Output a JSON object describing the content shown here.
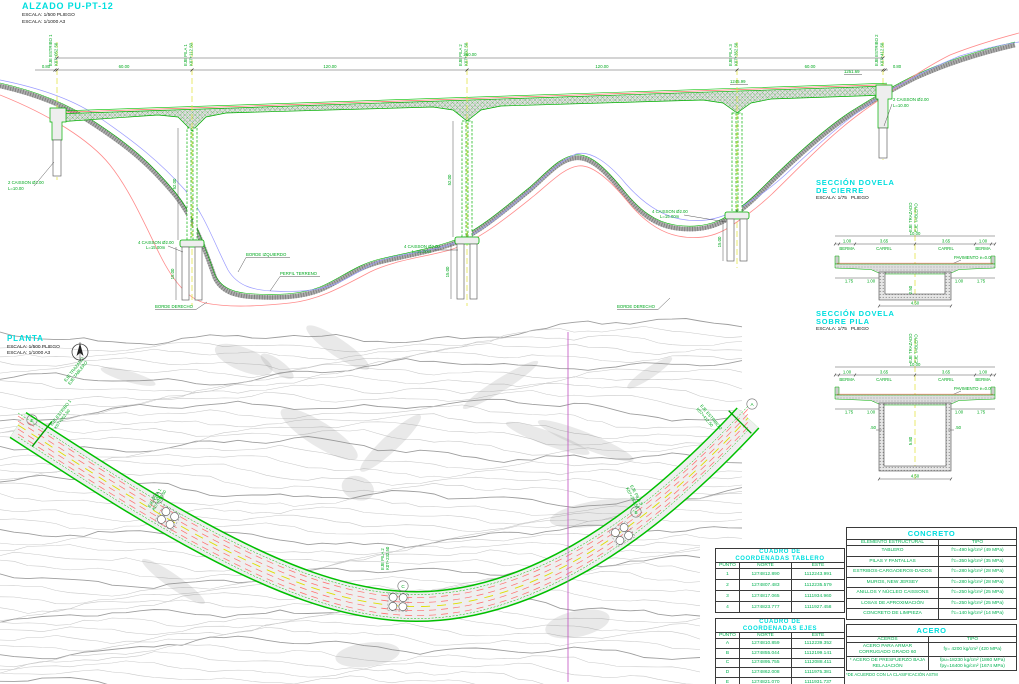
{
  "elevation": {
    "title": "ALZADO PU-PT-12",
    "scale1": "ESCALA: 1/500 PLIEGO",
    "scale2": "ESCALA: 1/1000 A3",
    "total_dim": "360.00",
    "dims": [
      "0.80",
      "60.00",
      "120.00",
      "120.00",
      "60.00",
      "0.80"
    ],
    "axes": [
      {
        "name": "EJE ESTRIBO 1",
        "station": "K07+052.50"
      },
      {
        "name": "EJE PILA 1",
        "station": "K07+112.50"
      },
      {
        "name": "EJE PILA 2",
        "station": "K07+232.50"
      },
      {
        "name": "EJE PILA 3",
        "station": "K07+352.50"
      },
      {
        "name": "EJE ESTRIBO 2",
        "station": "K07+412.50"
      }
    ],
    "caisson_abutment": "2 CAISSON Ø2.00",
    "caisson_abutment_len": "L=10.00",
    "caisson_pier": "4 CAISSON Ø2.00",
    "caisson_pier_len": "L=15.00m",
    "terrain": {
      "borde_izquierdo": "BORDE IZQUIERDO",
      "perfil": "PERFIL TERRENO",
      "borde_derecho": "BORDE DERECHO"
    },
    "pier_height": "52.00",
    "caisson_depth": "15.00",
    "spot_levels": [
      "1245.99",
      "1251.69"
    ]
  },
  "sections": {
    "cierre": {
      "title": "SECCIÓN DOVELA\nDE CIERRE",
      "scale": "ESCALA: 1/75   PLIEGO",
      "depth": "2.50"
    },
    "pila": {
      "title": "SECCIÓN DOVELA\nSOBRE PILA",
      "scale": "ESCALA: 1/75   PLIEGO",
      "depth": "5.80",
      "wall": ".50"
    },
    "labels": {
      "eje_trazado": "EJE TRAZADO",
      "eje_tablero": "EJE TABLERO",
      "total": "10.00",
      "berma": "BERMA",
      "carril": "CARRIL",
      "d_berma": "1.00",
      "d_carril": "3.65",
      "pavimento": "PAVIMENTO e=0.05",
      "d_wing": "1.75",
      "d_inner": "1.00",
      "d_bottom": "4.50"
    }
  },
  "plan": {
    "title": "PLANTA",
    "scale1": "ESCALA: 1/500 PLIEGO",
    "scale2": "ESCALA: 1/1000 A3",
    "eje_trazado": "EJE TRAZADO",
    "eje_tablero": "EJE TABLERO",
    "points": [
      "A",
      "B",
      "C",
      "D",
      "E"
    ]
  },
  "tables": {
    "tablero": {
      "title": "CUADRO DE\nCOORDENADAS TABLERO",
      "headers": [
        "PUNTO",
        "NORTE",
        "ESTE"
      ],
      "rows": [
        [
          "1",
          "1274812.890",
          "1112243.991"
        ],
        [
          "2",
          "1274807.483",
          "1112235.579"
        ],
        [
          "3",
          "1274817.065",
          "1111934.960"
        ],
        [
          "4",
          "1274823.777",
          "1111927.458"
        ]
      ]
    },
    "ejes": {
      "title": "CUADRO DE\nCOORDENADAS EJES",
      "headers": [
        "PUNTO",
        "NORTE",
        "ESTE"
      ],
      "rows": [
        [
          "A",
          "1274810.859",
          "1112239.352"
        ],
        [
          "B",
          "1274855.044",
          "1112199.141"
        ],
        [
          "C",
          "1274895.755",
          "1112088.411"
        ],
        [
          "D",
          "1274862.008",
          "1111975.381"
        ],
        [
          "E",
          "1274821.070",
          "1111931.737"
        ]
      ]
    },
    "concreto": {
      "title": "CONCRETO",
      "headers": [
        "ELEMENTO ESTRUCTURAL",
        "TIPO"
      ],
      "rows": [
        [
          "TABLERO",
          "f'c=490 kg/cm² (49 MPa)"
        ],
        [
          "PILAS Y PANTALLAS",
          "f'c=350 kg/cm² (35 MPa)"
        ],
        [
          "ESTRIBOS-CARGADEROS-DADOS",
          "f'c=280 kg/cm² (28 MPa)"
        ],
        [
          "MUROS, NEW JERSEY",
          "f'c=280 kg/cm² (28 MPa)"
        ],
        [
          "ANILLOS Y NÚCLEO CAISSONS",
          "f'c=250 kg/cm² (25 MPa)"
        ],
        [
          "LOSAS DE APROXIMACIÓN",
          "f'c=250 kg/cm² (25 MPa)"
        ],
        [
          "CONCRETO DE LIMPIEZA",
          "f'c=140 kg/cm² (14 MPa)"
        ]
      ]
    },
    "acero": {
      "title": "ACERO",
      "headers": [
        "ACEROS",
        "TIPO"
      ],
      "rows": [
        [
          "ACERO PARA ARMAR CORRUGADO GRADO 60",
          "fy= 4200 kg/cm² (420 MPa)"
        ],
        [
          "* ACERO DE PRESFUERZO BAJA RELAJACIÓN",
          "fpu=18230 kg/cm² (1860 MPa)\nfpy=16400 kg/cm² (1674 MPa)"
        ]
      ],
      "footnote": "*DE ACUERDO CON LA CLASIFICACIÓN ASTM"
    }
  }
}
